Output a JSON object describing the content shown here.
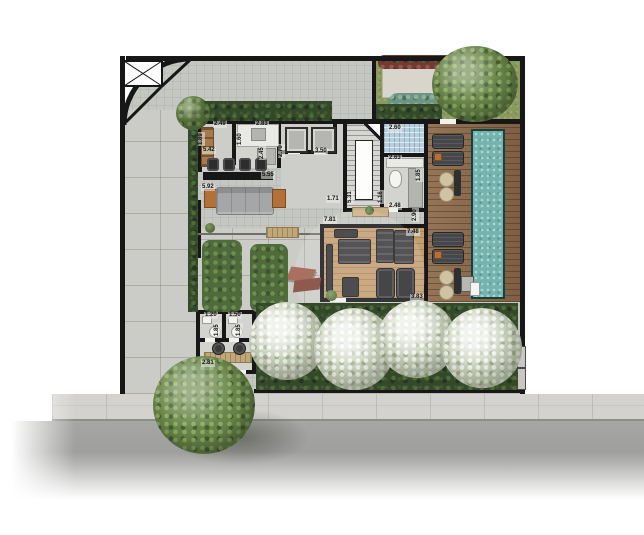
{
  "meta": {
    "type": "architectural-floor-plan"
  },
  "dimensions": [
    "2.49",
    "2.83",
    "5.42",
    "1.89",
    "1.60",
    "2.45",
    "2.70",
    "3.50",
    "2.60",
    "2.63",
    "1.85",
    "5.55",
    "5.92",
    "1.71",
    "5.31",
    "1.16",
    "2.48",
    "7.81",
    "7.48",
    "2.90",
    "3.83",
    "1.20",
    "1.50",
    "1.85",
    "1.85",
    "2.81"
  ],
  "colors": {
    "wall": "#171717",
    "paving": "#c5c7c2",
    "pool_water": "#74b3ae",
    "deck_wood": "#8d6a4a",
    "gym_wood": "#c49d70",
    "hedge_green": "#34482a",
    "lawn_green": "#8a9a5f",
    "white_tree": "#c9d1bc",
    "street_gray": "#9c9c9a",
    "sidewalk_gray": "#d3d2ce",
    "accent_wood": "#b5703a",
    "shower_tile": "#b7cedd"
  }
}
